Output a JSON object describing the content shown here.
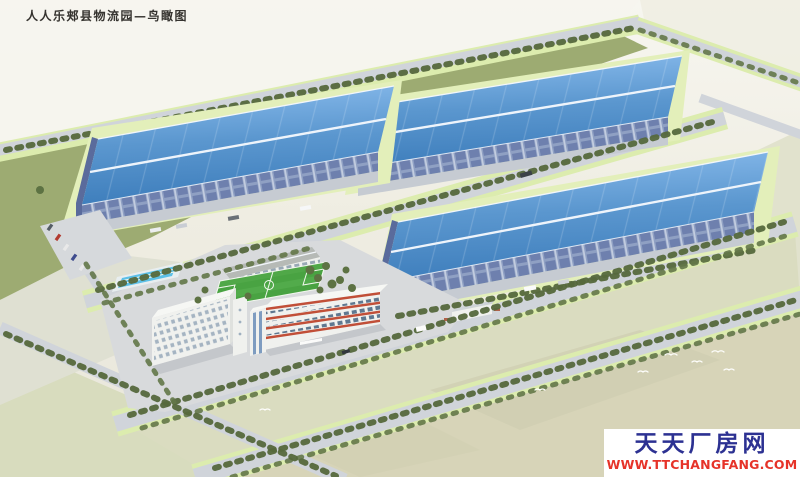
{
  "header": {
    "title": "人人乐郏县物流园—鸟瞰图"
  },
  "watermark": {
    "site_name": "天天厂房网",
    "site_url": "WWW.TTCHANGFANG.COM",
    "site_name_color": "#2c3192",
    "site_url_color": "#e63329",
    "background": "#ffffff"
  },
  "palette": {
    "warehouse_roof_light": "#8abced",
    "warehouse_roof_dark": "#3e7ebc",
    "warehouse_wall": "#8fa0c3",
    "ridge_white": "#eef4fb",
    "apron_green": "#e3efba",
    "lawn_green": "#9dab72",
    "tree_green": "#55683c",
    "field_green": "#49a342",
    "pool_blue": "#5cc0e8",
    "road_gray": "#d0d4da",
    "ground_olive": "#d6dabc",
    "ground_beige": "#d7d4b8",
    "office_accent_red": "#c14f38",
    "building_white": "#f0f1ee"
  },
  "scene": {
    "type": "aerial-architectural-rendering",
    "features": [
      "three blue-roof warehouses",
      "dormitory building",
      "office building with red bands",
      "canteen building",
      "football field",
      "swimming pool",
      "tree-lined roads",
      "vacant land parcels",
      "flying birds"
    ]
  }
}
